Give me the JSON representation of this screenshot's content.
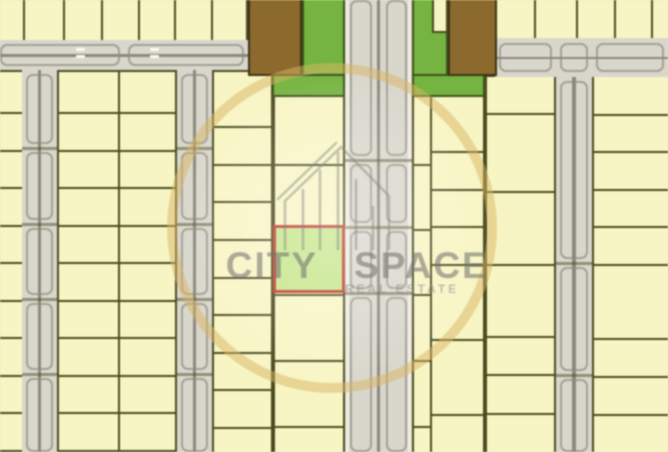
{
  "watermark": {
    "brand_left": "CITY",
    "brand_right": "SPACE",
    "tagline": "REAL ESTATE",
    "ring_color": "#d9b662",
    "icon_color": "#87877f",
    "text_color": "#74746e"
  },
  "palette": {
    "background": "#f1edbc",
    "plot_fill": "#f8f5c3",
    "plot_line": "#4b4a1f",
    "road_fill": "#d9d7cc",
    "road_line": "#a3a196",
    "road_median": "#8b897e",
    "road_stripe": "#f0eee2",
    "road_dash": "#fbfaf2",
    "park_green": "#74b53d",
    "park_line": "#3f511a",
    "building_brown": "#8d6a2b",
    "building_line": "#3e3414",
    "highlight_fill": "#c6e688",
    "highlight_border": "#c23b27"
  },
  "map": {
    "columns": [
      {
        "x": -6,
        "y": -6,
        "w": 254,
        "h": 48,
        "dividers": [
          22,
          62,
          100,
          137,
          173,
          210
        ]
      },
      {
        "x": 495,
        "y": -6,
        "w": 175,
        "h": 46,
        "dividers": [
          533,
          575,
          613,
          650
        ]
      },
      {
        "x": -6,
        "y": 70,
        "w": 30,
        "h": 386,
        "rows": [
          111,
          149,
          186,
          224,
          261,
          299,
          336,
          374,
          411,
          449
        ]
      },
      {
        "x": 57,
        "y": 70,
        "w": 120,
        "h": 386,
        "dividers": [
          117
        ],
        "rows": [
          111,
          149,
          186,
          224,
          261,
          299,
          336,
          374,
          411,
          449
        ]
      },
      {
        "x": 212,
        "y": 70,
        "w": 61,
        "h": 386,
        "rows": [
          125,
          163,
          200,
          238,
          276,
          313,
          351,
          388,
          426
        ]
      },
      {
        "x": 273,
        "y": 95,
        "w": 72,
        "h": 361,
        "rows": [
          163,
          228,
          293,
          359,
          425
        ]
      },
      {
        "x": 412,
        "y": 95,
        "w": 20,
        "h": 361,
        "rows": [
          163,
          228,
          293,
          359,
          425
        ]
      },
      {
        "x": 430,
        "y": 95,
        "w": 55,
        "h": 361,
        "rows": [
          150,
          188,
          225,
          263,
          338,
          413
        ]
      },
      {
        "x": 485,
        "y": 75,
        "w": 71,
        "h": 381,
        "rows": [
          112,
          190,
          263,
          335,
          373,
          412
        ]
      },
      {
        "x": 592,
        "y": 75,
        "w": 78,
        "h": 381,
        "rows": [
          113,
          150,
          188,
          225,
          263,
          337,
          375,
          413
        ]
      }
    ],
    "roads": [
      {
        "dir": "v",
        "x": 345,
        "y": -4,
        "w": 67,
        "h": 460,
        "breaks": [
          -4,
          160,
          227,
          293,
          456
        ],
        "moduleCols": [
          [
            5,
            27
          ],
          [
            41,
            62
          ]
        ],
        "median": true,
        "stripes": true,
        "crossings": [
          160,
          227,
          293
        ]
      },
      {
        "dir": "v",
        "x": 22,
        "y": 70,
        "w": 35,
        "h": 386,
        "breaks": [
          70,
          148,
          224,
          299,
          374,
          456
        ],
        "moduleCols": [
          [
            4,
            31
          ]
        ],
        "median": true,
        "crossings": [
          148,
          224,
          299,
          374
        ]
      },
      {
        "dir": "v",
        "x": 177,
        "y": 70,
        "w": 35,
        "h": 386,
        "breaks": [
          70,
          148,
          224,
          299,
          374,
          456
        ],
        "moduleCols": [
          [
            4,
            31
          ]
        ],
        "median": true,
        "crossings": [
          148,
          224,
          299,
          374
        ]
      },
      {
        "dir": "v",
        "x": 556,
        "y": 40,
        "w": 36,
        "h": 416,
        "breaks": [
          40,
          77,
          263,
          375,
          456
        ],
        "moduleCols": [
          [
            4,
            32
          ]
        ],
        "median": true,
        "crossings": [
          263,
          375
        ]
      },
      {
        "dir": "h",
        "x": -4,
        "y": 40,
        "w": 252,
        "h": 30,
        "breaks": [
          -4,
          124,
          248
        ],
        "moduleRows": [
          [
            4,
            26
          ]
        ],
        "median": true,
        "dashes": [
          {
            "x": 76,
            "y": 48
          },
          {
            "x": 76,
            "y": 55
          },
          {
            "x": 150,
            "y": 48
          },
          {
            "x": 150,
            "y": 55
          }
        ]
      },
      {
        "dir": "h",
        "x": 495,
        "y": 38,
        "w": 173,
        "h": 39,
        "breaks": [
          495,
          556,
          592,
          668
        ],
        "moduleRows": [
          [
            5,
            34
          ]
        ],
        "median": true
      }
    ],
    "parks": [
      {
        "x": 302,
        "y": -4,
        "w": 43,
        "h": 101
      },
      {
        "x": 272,
        "y": 74,
        "w": 73,
        "h": 23
      },
      {
        "x": 412,
        "y": -4,
        "w": 36,
        "h": 101
      },
      {
        "x": 412,
        "y": 74,
        "w": 73,
        "h": 23
      }
    ],
    "notches": [
      {
        "x": 432,
        "y": -4,
        "w": 16,
        "h": 37
      }
    ],
    "buildings": [
      {
        "x": 248,
        "y": -4,
        "w": 54,
        "h": 80
      },
      {
        "x": 448,
        "y": -4,
        "w": 49,
        "h": 80
      }
    ],
    "highlighted_plot": {
      "x": 273,
      "y": 225,
      "w": 72,
      "h": 68
    }
  }
}
